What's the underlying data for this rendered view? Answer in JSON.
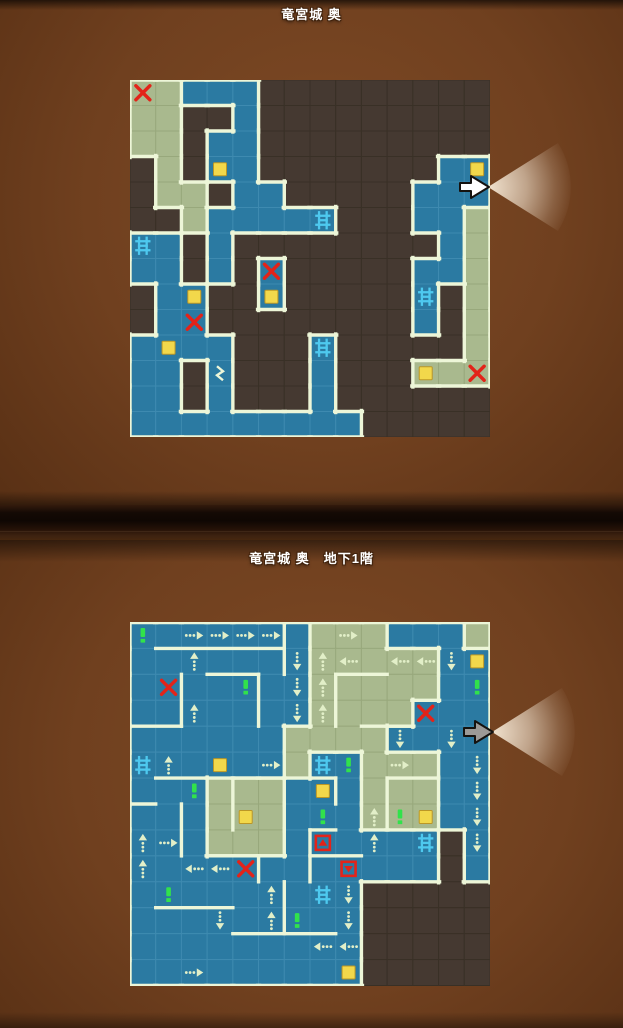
{
  "titles": {
    "top": "竜宮城 奥",
    "bottom": "竜宮城 奥　地下1階"
  },
  "palette": {
    "blue": "#2b7aa2",
    "blue_line": "#3e8ab0",
    "green": "#a9b98e",
    "green_line": "#98a87c",
    "dark": "#453931",
    "dark_line": "#393026",
    "wall": "#edf6d8",
    "chest": "#f2d84b",
    "chest_edge": "#bb9726",
    "red": "#e32319",
    "ladder": "#4ec9ef",
    "excl": "#31e24b",
    "arrow": "#e2efc8",
    "cursor_white": "#ffffff",
    "cursor_gray": "#9c9a97",
    "cone": "#fff4e2"
  },
  "maps": [
    {
      "id": "map-top",
      "title_key": "top",
      "x": 130,
      "y": 80,
      "cols": 14,
      "rows": 14,
      "cellW": 25.714,
      "cellH": 25.5,
      "grid": [
        "GGBBBDDDDDDDDD",
        "GGDDBDDDDDDDDD",
        "GGDBBDDDDDDDDD",
        "DGDBBDDDDDDDBB",
        "DGGDBBDDDDDBBB",
        "DDGBBBBBDDDBBG",
        "BBDBDDDDDDDDBG",
        "BBDBDBDDDDDBBG",
        "DBBDDBDDDDDBDG",
        "DBBDDDDDDDDBDG",
        "BBBBDDDBDDDDDG",
        "BBDBDDDBDDDGGG",
        "BBDBDDDBDDDDDD",
        "BBBBBBBBBDDDDD"
      ],
      "walls": [],
      "icons": [
        {
          "t": "x",
          "c": 0,
          "r": 0
        },
        {
          "t": "x",
          "c": 5,
          "r": 7
        },
        {
          "t": "x",
          "c": 2,
          "r": 9
        },
        {
          "t": "x",
          "c": 13,
          "r": 11
        },
        {
          "t": "chest",
          "c": 3,
          "r": 3
        },
        {
          "t": "chest",
          "c": 13,
          "r": 3
        },
        {
          "t": "chest",
          "c": 2,
          "r": 8
        },
        {
          "t": "chest",
          "c": 5,
          "r": 8
        },
        {
          "t": "chest",
          "c": 1,
          "r": 10
        },
        {
          "t": "chest",
          "c": 11,
          "r": 11
        },
        {
          "t": "ladder",
          "c": 0,
          "r": 6
        },
        {
          "t": "ladder",
          "c": 7,
          "r": 5
        },
        {
          "t": "ladder",
          "c": 11,
          "r": 8
        },
        {
          "t": "ladder",
          "c": 7,
          "r": 10
        },
        {
          "t": "zigzag",
          "c": 3,
          "r": 11
        }
      ]
    },
    {
      "id": "map-bottom",
      "title_key": "bottom",
      "x": 130,
      "y": 622,
      "cols": 14,
      "rows": 14,
      "cellW": 25.714,
      "cellH": 25.93,
      "grid": [
        "BBBBBBBGGGBBBG",
        "BBBBBBBGGGGGBB",
        "BBBBBBBGGGGGBB",
        "BBBBBBBGGGGBBB",
        "BBBBBBGGGGBBBB",
        "BBBBBBGBBGGGBB",
        "BBBGGGBBBGGGBB",
        "BBBGGGBBBGGGBB",
        "BBBGGGBBBBBBDB",
        "BBBBBBBBBBBBDB",
        "BBBBBBBBBDDDDD",
        "BBBBBBBBBDDDDD",
        "BBBBBBBBBDDDDD",
        "BBBBBBBBBDDDDD"
      ],
      "walls": [
        [
          1,
          1,
          6,
          1
        ],
        [
          6,
          0,
          6,
          2
        ],
        [
          2,
          2,
          2,
          4
        ],
        [
          0,
          4,
          2,
          4
        ],
        [
          3,
          2,
          5,
          2
        ],
        [
          5,
          2,
          5,
          4
        ],
        [
          8,
          2,
          8,
          4
        ],
        [
          8,
          2,
          10,
          2
        ],
        [
          9,
          4,
          11,
          4
        ],
        [
          1,
          6,
          3,
          6
        ],
        [
          0,
          7,
          1,
          7
        ],
        [
          2,
          7,
          2,
          9
        ],
        [
          4,
          6,
          6,
          6
        ],
        [
          4,
          6,
          4,
          8
        ],
        [
          7,
          6,
          8,
          6
        ],
        [
          8,
          6,
          8,
          7
        ],
        [
          10,
          6,
          12,
          6
        ],
        [
          10,
          6,
          10,
          8
        ],
        [
          7,
          8,
          7,
          10
        ],
        [
          7,
          8,
          8,
          8
        ],
        [
          3,
          9,
          6,
          9
        ],
        [
          5,
          9,
          5,
          10
        ],
        [
          7,
          9,
          9,
          9
        ],
        [
          1,
          11,
          4,
          11
        ],
        [
          6,
          10,
          6,
          12
        ],
        [
          4,
          12,
          8,
          12
        ]
      ],
      "icons": [
        {
          "t": "x",
          "c": 1,
          "r": 2
        },
        {
          "t": "x",
          "c": 11,
          "r": 3
        },
        {
          "t": "x",
          "c": 4,
          "r": 9
        },
        {
          "t": "chest",
          "c": 13,
          "r": 1
        },
        {
          "t": "chest",
          "c": 3,
          "r": 5
        },
        {
          "t": "chest",
          "c": 7,
          "r": 6
        },
        {
          "t": "chest",
          "c": 4,
          "r": 7
        },
        {
          "t": "chest",
          "c": 11,
          "r": 7
        },
        {
          "t": "chest",
          "c": 8,
          "r": 13
        },
        {
          "t": "ladder",
          "c": 0,
          "r": 5
        },
        {
          "t": "ladder",
          "c": 7,
          "r": 5
        },
        {
          "t": "ladder",
          "c": 11,
          "r": 8
        },
        {
          "t": "ladder",
          "c": 7,
          "r": 10
        },
        {
          "t": "excl",
          "c": 0,
          "r": 0
        },
        {
          "t": "excl",
          "c": 4,
          "r": 2
        },
        {
          "t": "excl",
          "c": 13,
          "r": 2
        },
        {
          "t": "excl",
          "c": 8,
          "r": 5
        },
        {
          "t": "excl",
          "c": 2,
          "r": 6
        },
        {
          "t": "excl",
          "c": 7,
          "r": 7
        },
        {
          "t": "excl",
          "c": 10,
          "r": 7
        },
        {
          "t": "excl",
          "c": 1,
          "r": 10
        },
        {
          "t": "excl",
          "c": 6,
          "r": 11
        },
        {
          "t": "redsq_up",
          "c": 7,
          "r": 8
        },
        {
          "t": "redsq_down",
          "c": 8,
          "r": 9
        },
        {
          "t": "aR",
          "c": 2,
          "r": 0
        },
        {
          "t": "aR",
          "c": 3,
          "r": 0
        },
        {
          "t": "aR",
          "c": 4,
          "r": 0
        },
        {
          "t": "aR",
          "c": 5,
          "r": 0
        },
        {
          "t": "aR",
          "c": 8,
          "r": 0
        },
        {
          "t": "aR",
          "c": 5,
          "r": 5
        },
        {
          "t": "aR",
          "c": 10,
          "r": 5
        },
        {
          "t": "aR",
          "c": 1,
          "r": 8
        },
        {
          "t": "aR",
          "c": 2,
          "r": 13
        },
        {
          "t": "aL",
          "c": 8,
          "r": 1
        },
        {
          "t": "aL",
          "c": 10,
          "r": 1
        },
        {
          "t": "aL",
          "c": 11,
          "r": 1
        },
        {
          "t": "aL",
          "c": 2,
          "r": 9
        },
        {
          "t": "aL",
          "c": 3,
          "r": 9
        },
        {
          "t": "aL",
          "c": 7,
          "r": 12
        },
        {
          "t": "aL",
          "c": 8,
          "r": 12
        },
        {
          "t": "aU",
          "c": 2,
          "r": 1
        },
        {
          "t": "aU",
          "c": 7,
          "r": 1
        },
        {
          "t": "aU",
          "c": 7,
          "r": 2
        },
        {
          "t": "aU",
          "c": 7,
          "r": 3
        },
        {
          "t": "aU",
          "c": 2,
          "r": 3
        },
        {
          "t": "aU",
          "c": 1,
          "r": 5
        },
        {
          "t": "aU",
          "c": 0,
          "r": 8
        },
        {
          "t": "aU",
          "c": 0,
          "r": 9
        },
        {
          "t": "aU",
          "c": 9,
          "r": 7
        },
        {
          "t": "aU",
          "c": 9,
          "r": 8
        },
        {
          "t": "aU",
          "c": 5,
          "r": 10
        },
        {
          "t": "aU",
          "c": 5,
          "r": 11
        },
        {
          "t": "aD",
          "c": 6,
          "r": 1
        },
        {
          "t": "aD",
          "c": 6,
          "r": 2
        },
        {
          "t": "aD",
          "c": 6,
          "r": 3
        },
        {
          "t": "aD",
          "c": 12,
          "r": 1
        },
        {
          "t": "aD",
          "c": 10,
          "r": 4
        },
        {
          "t": "aD",
          "c": 12,
          "r": 4
        },
        {
          "t": "aD",
          "c": 13,
          "r": 5
        },
        {
          "t": "aD",
          "c": 13,
          "r": 6
        },
        {
          "t": "aD",
          "c": 13,
          "r": 7
        },
        {
          "t": "aD",
          "c": 13,
          "r": 8
        },
        {
          "t": "aD",
          "c": 3,
          "r": 11
        },
        {
          "t": "aD",
          "c": 8,
          "r": 10
        },
        {
          "t": "aD",
          "c": 8,
          "r": 11
        }
      ]
    }
  ],
  "cursors": [
    {
      "x": 480,
      "y": 187,
      "style": "white"
    },
    {
      "x": 484,
      "y": 732,
      "style": "gray"
    }
  ]
}
